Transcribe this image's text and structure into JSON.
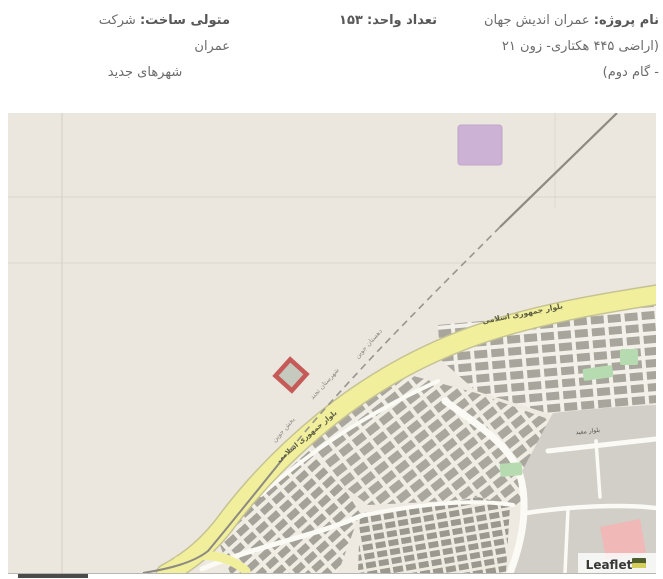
{
  "header": {
    "project": {
      "label": "نام پروژه:",
      "name": "عمران اندیش جهان",
      "line2": "(اراضی ۴۴۵ هکتاری- زون ۲۱",
      "line3": "- گام دوم)"
    },
    "units": {
      "label": "تعداد واحد:",
      "value": "۱۵۳"
    },
    "builder": {
      "label": "متولی ساخت:",
      "name": "شرکت عمران",
      "line2": "شهرهای جدید"
    }
  },
  "map": {
    "attribution": "Leaflet",
    "boulevard_label": "بلوار جمهوری اسلامی",
    "street_label": "بلوار مفید",
    "boundary_labels": {
      "l1": "دهستان جوین",
      "l2": "شهرستان تجند",
      "l3": "بخش جوین"
    },
    "colors": {
      "terrain": "#ebe7df",
      "boulevard": "#f1ef9c",
      "boulevard_casing": "#c5c393",
      "urban_open": "#d2cfc8",
      "blocks": "#a8a59d",
      "roads_white": "#fbfaf5",
      "park_green": "#b7dbb0",
      "pink_area": "#f0b8b6",
      "marker_red": "#c55a58",
      "zone_purple": "#ccb3d6",
      "boundary_gray": "#8d8a82"
    }
  }
}
